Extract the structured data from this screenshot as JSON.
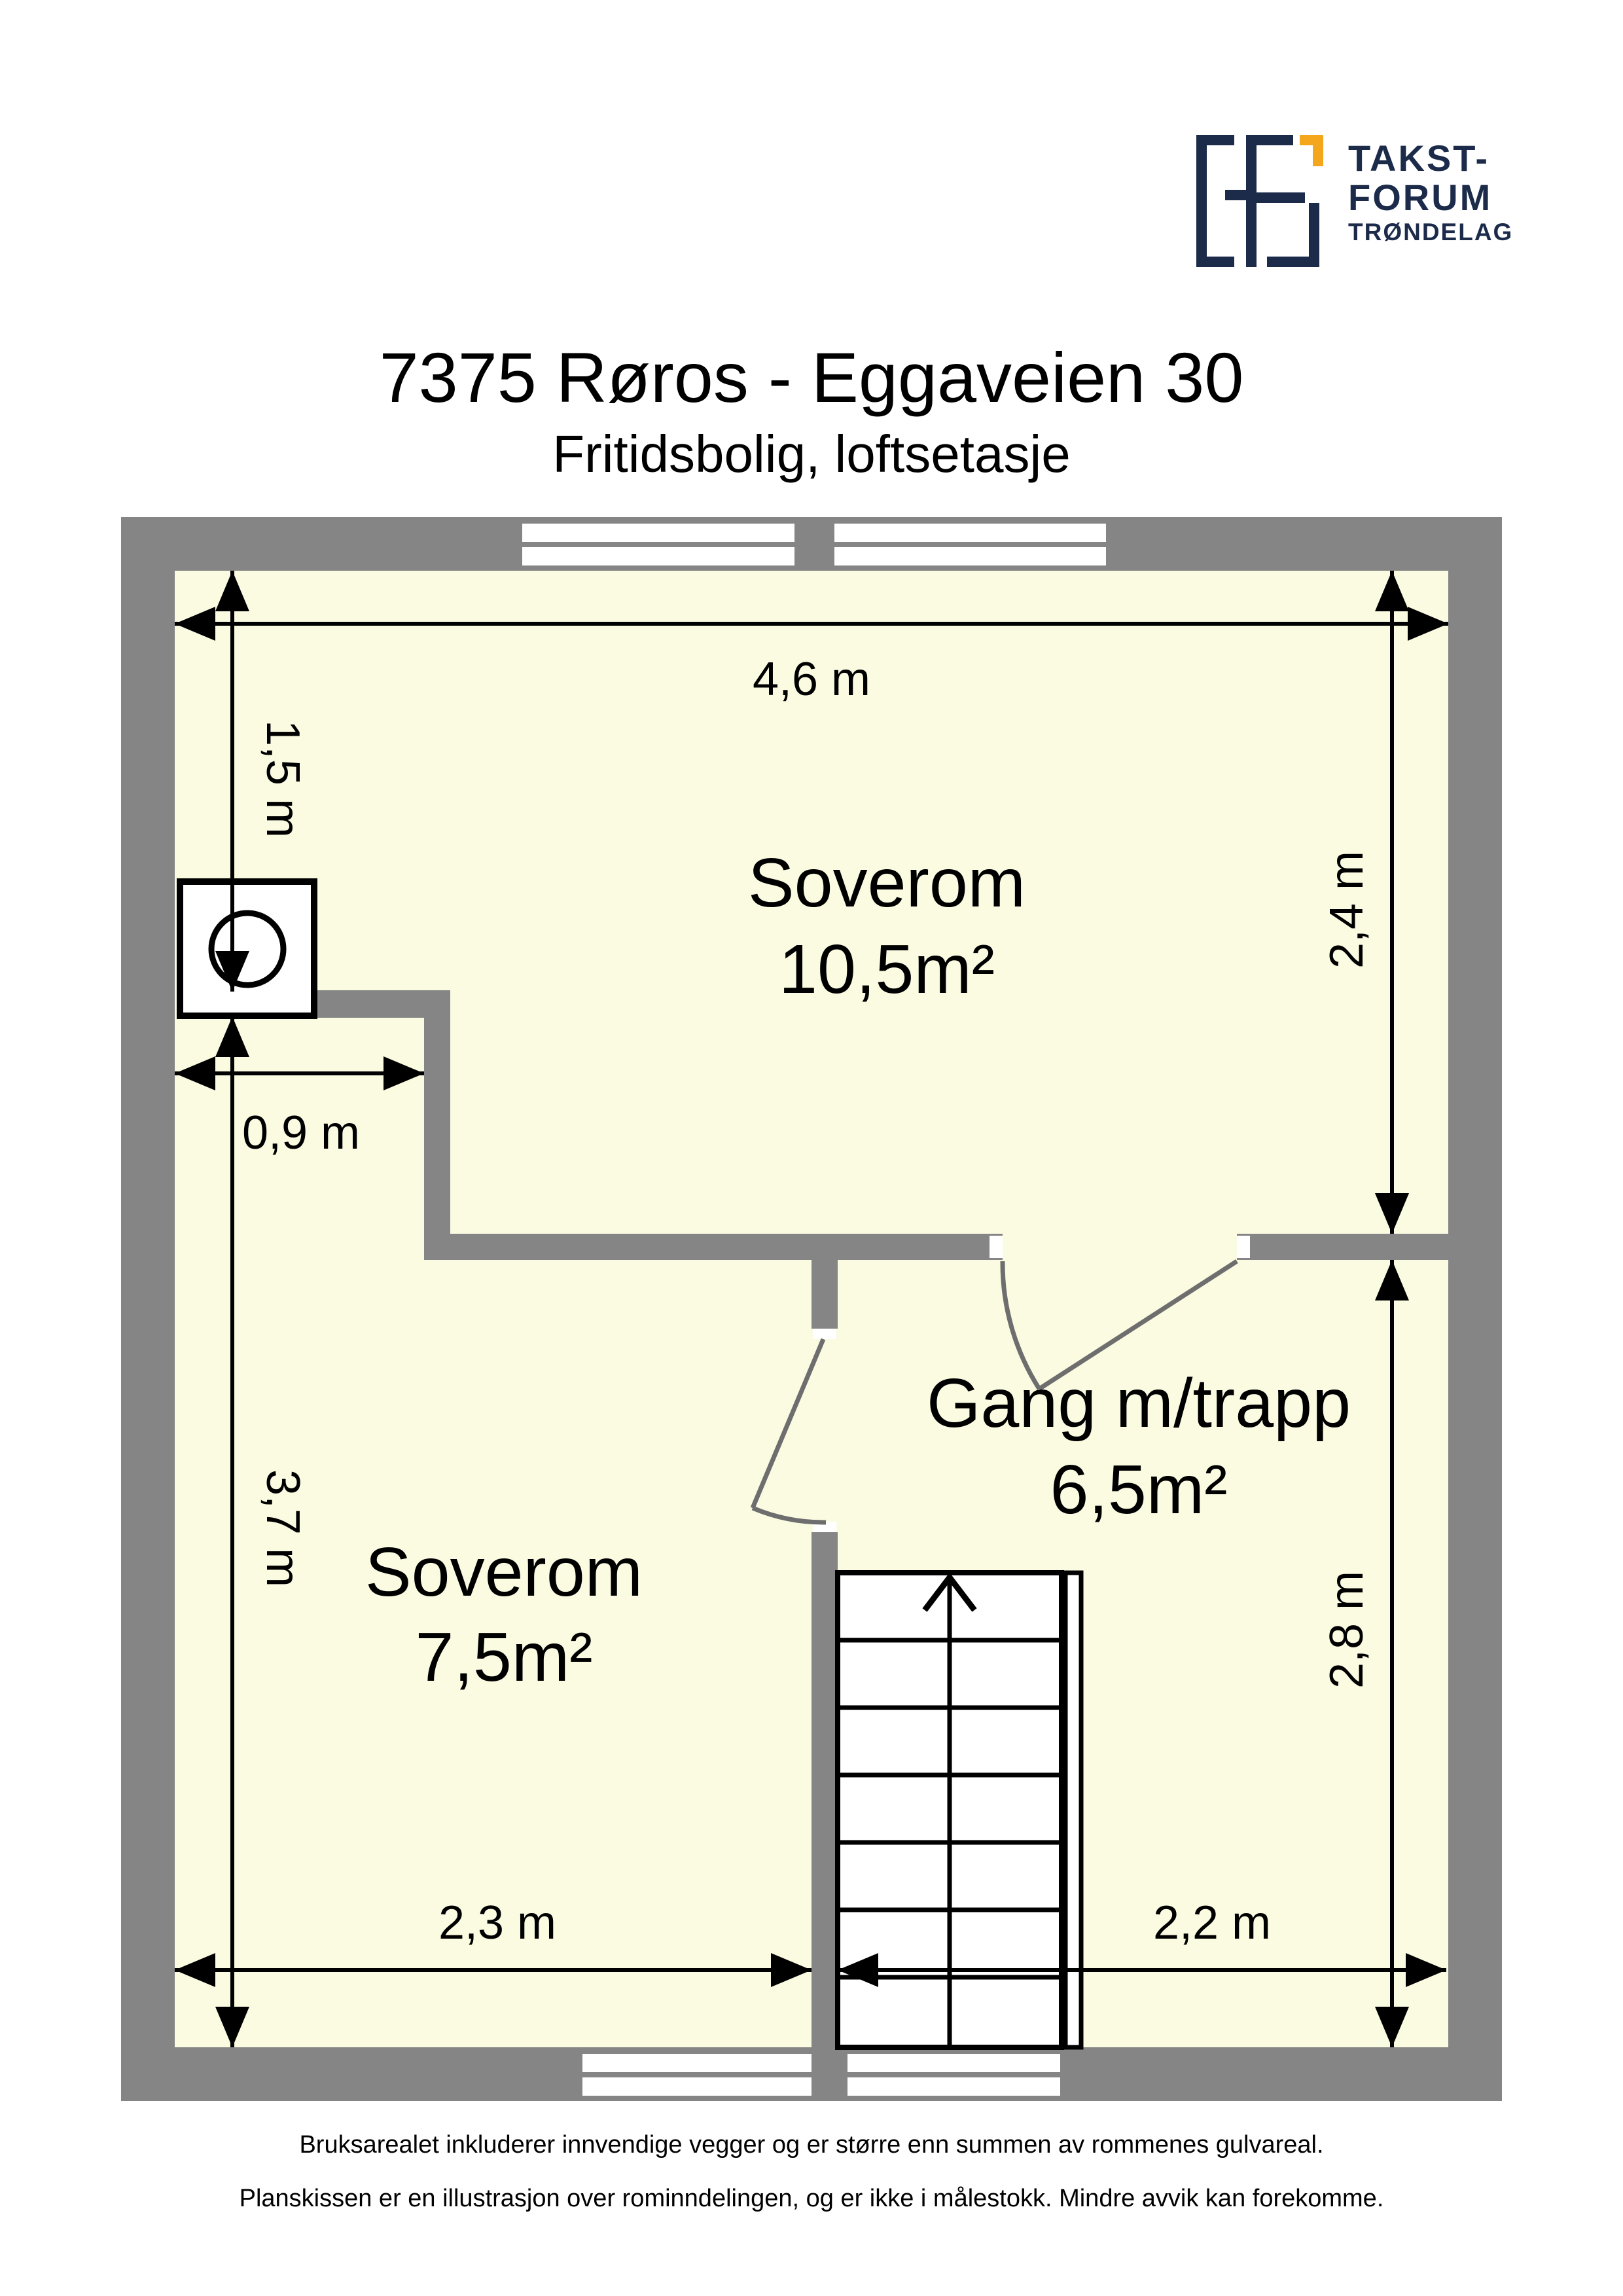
{
  "header": {
    "logo": {
      "line1": "TAKST-",
      "line2": "FORUM",
      "line3": "TRØNDELAG"
    },
    "title": "7375 Røros - Eggaveien 30",
    "subtitle": "Fritidsbolig, loftsetasje"
  },
  "plan": {
    "rooms": [
      {
        "name": "Soverom",
        "area": "10,5m²"
      },
      {
        "name": "Gang m/trapp",
        "area": "6,5m²"
      },
      {
        "name": "Soverom",
        "area": "7,5m²"
      }
    ],
    "dimensions": {
      "top": "4,6 m",
      "left_upper": "1,5 m",
      "left_lower": "3,7 m",
      "right_upper": "2,4 m",
      "right_lower": "2,8 m",
      "chimney_offset": "0,9 m",
      "bottom_left": "2,3 m",
      "bottom_right": "2,2 m"
    }
  },
  "footer": {
    "line1": "Bruksarealet inkluderer innvendige vegger og er større enn summen av rommenes gulvareal.",
    "line2": "Planskissen er en illustrasjon over rominndelingen, og er ikke i målestokk. Mindre avvik kan forekomme."
  },
  "colors": {
    "wall_gray": "#858585",
    "floor_yellow": "#FBFBE2",
    "brand_navy": "#1C2B4A",
    "brand_orange": "#F4A71D"
  }
}
